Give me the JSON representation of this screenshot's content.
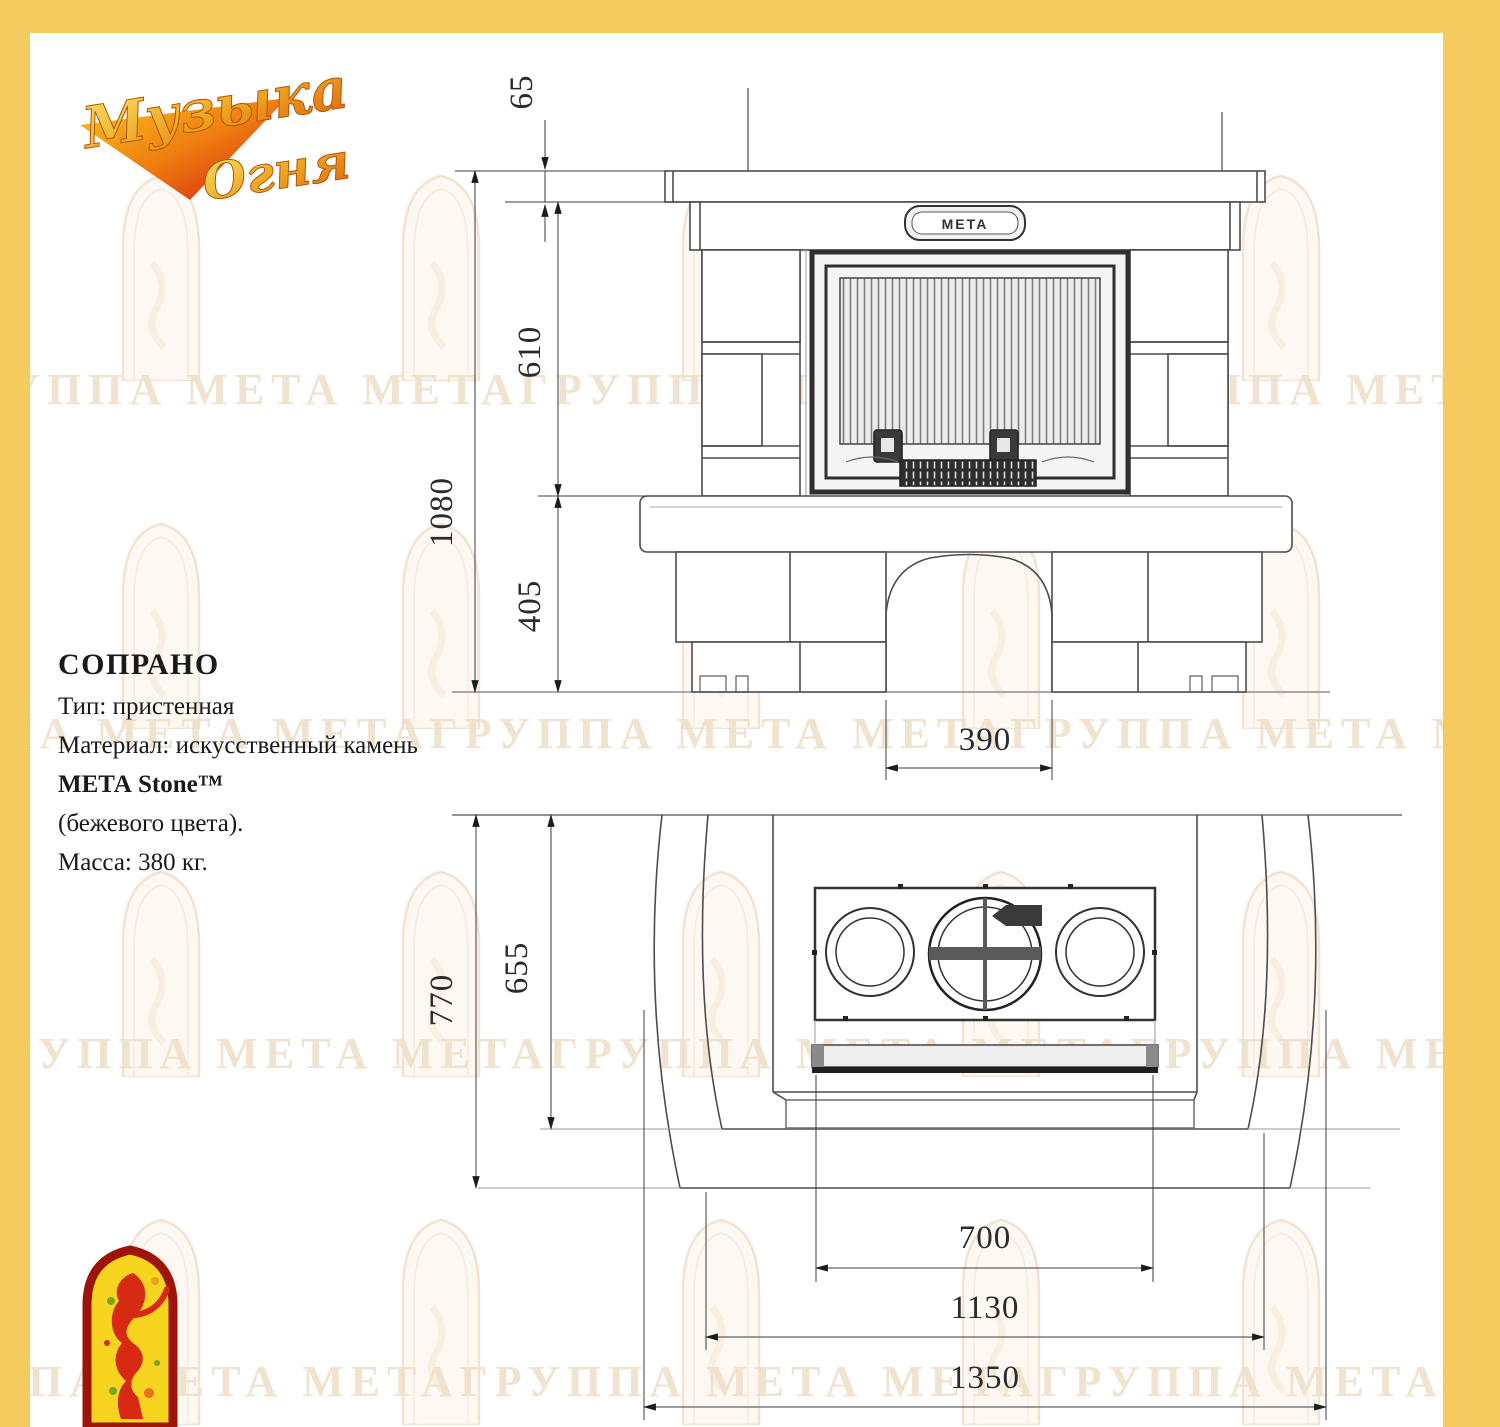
{
  "logo": {
    "line1": "Музыка",
    "line2": "Огня"
  },
  "info": {
    "title": "СОПРАНО",
    "type": "Тип: пристенная",
    "material1": "Материал: искусственный камень",
    "material2": "МЕТА Stone™",
    "material3": "(бежевого цвета).",
    "mass": "Масса: 380 кг."
  },
  "front_dims": {
    "shelf_thickness": "65",
    "firebox_height": "610",
    "total_height": "1080",
    "base_height": "405",
    "arch_width": "390"
  },
  "plan_dims": {
    "total_depth": "770",
    "body_depth": "655",
    "insert_width": "700",
    "body_width": "1130",
    "total_width": "1350"
  },
  "insert": {
    "brand_plate": "МЕТА"
  },
  "watermark": {
    "row": "ГРУППА МЕТА МЕТАГРУППА МЕТА МЕТАГРУППА МЕТА МЕТАГРУППА МЕТА"
  },
  "colors": {
    "border": "#f5ca5e",
    "line": "#4d4d4d",
    "dark": "#262626",
    "watermark": "#f2e3d2"
  }
}
